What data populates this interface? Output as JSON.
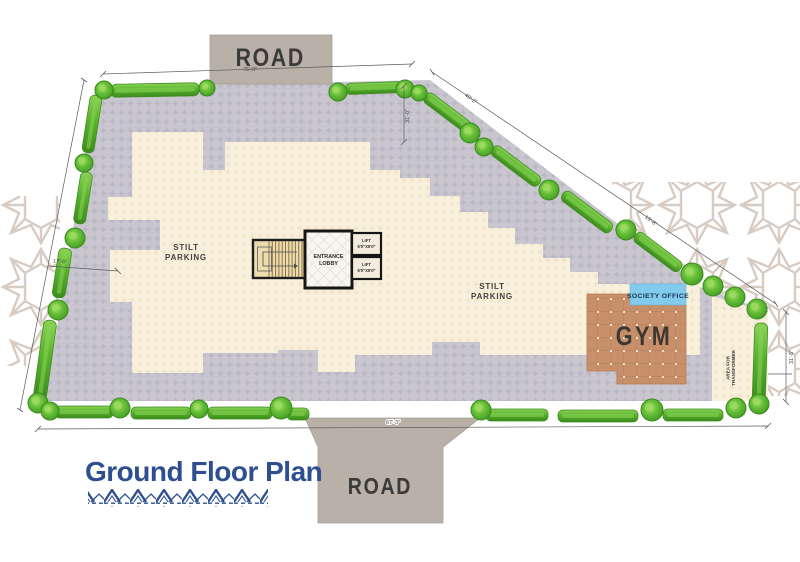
{
  "title": {
    "text": "Ground Floor Plan"
  },
  "roads": {
    "top": "ROAD",
    "bottom": "ROAD"
  },
  "areas": {
    "stilt_parking_left": {
      "line1": "STILT",
      "line2": "PARKING"
    },
    "stilt_parking_right": {
      "line1": "STILT",
      "line2": "PARKING"
    },
    "gym": "GYM",
    "society_office": "SOCIETY OFFICE",
    "transformer": {
      "line1": "AREA FOR",
      "line2": "TRANSFORMER"
    },
    "entrance_lobby": {
      "line1": "ENTRANCE",
      "line2": "LOBBY"
    },
    "lift1": {
      "line1": "LIFT",
      "line2": "5'0\"X5'0\""
    },
    "lift2": {
      "line1": "LIFT",
      "line2": "5'0\"X5'0\""
    }
  },
  "dimensions": {
    "top": "75'-0\"",
    "bottom": "67'-3\"",
    "left_short": "17'-6\"",
    "diag1": "40'-2\"",
    "diag2": "19'-8\"",
    "right": "31'-5\"",
    "inner_top": "31'-0\""
  },
  "colors": {
    "paving": "#c9c6d0",
    "paving_motif": "#b8b5c2",
    "cream": "#f8f0dc",
    "cream_motif": "#efe3c8",
    "hedge_green": "#58b22e",
    "tree_green": "#64bd37",
    "gym_floor": "#c8906a",
    "society_blue": "#82cbec",
    "road_gray": "#b9b1a7",
    "title_blue": "#2d4f8f",
    "line_gray": "#5a5a5a",
    "ink": "#3a3a38"
  }
}
